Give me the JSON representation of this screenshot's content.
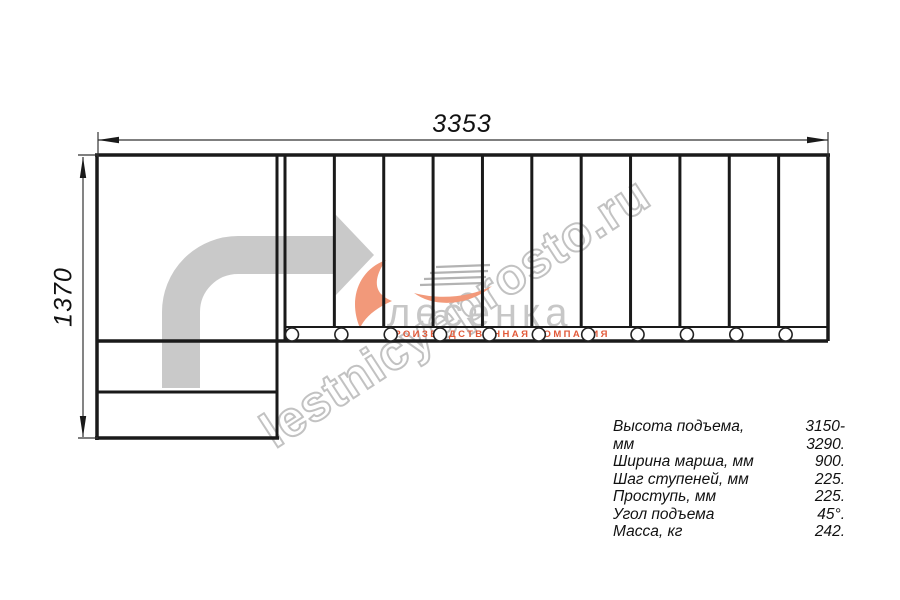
{
  "drawing": {
    "title_hint": "staircase-plan-view",
    "width_dim": "3353",
    "height_dim": "1370",
    "steps": {
      "count": 11,
      "x_start": 285,
      "x_end": 828,
      "y_top": 155,
      "y_bottom": 327
    },
    "balusters": {
      "count": 11,
      "y": 334.5,
      "r": 6.5,
      "offset": 7
    },
    "colors": {
      "line": "#1a1a1a",
      "arrow_gray": "#c9c9c9",
      "watermark_gray": "#b7b7b7",
      "logo_gray": "#c7c7c7",
      "logo_orange": "#f2997a",
      "logo_sub_orange": "#e25a3a"
    }
  },
  "watermark": {
    "text": "lestnicyeprosto.ru"
  },
  "logo": {
    "name": "лесенка",
    "subtitle": "ПРОИЗВОДСТВЕННАЯ КОМПАНИЯ"
  },
  "specs": {
    "rows": [
      {
        "label": "Высота подъема, мм",
        "value": "3150-3290."
      },
      {
        "label": "Ширина марша, мм",
        "value": "900."
      },
      {
        "label": "Шаг ступеней, мм",
        "value": "225."
      },
      {
        "label": "Проступь, мм",
        "value": "225."
      },
      {
        "label": "Угол подъема",
        "value": "45°."
      },
      {
        "label": "Масса, кг",
        "value": "242."
      }
    ]
  }
}
